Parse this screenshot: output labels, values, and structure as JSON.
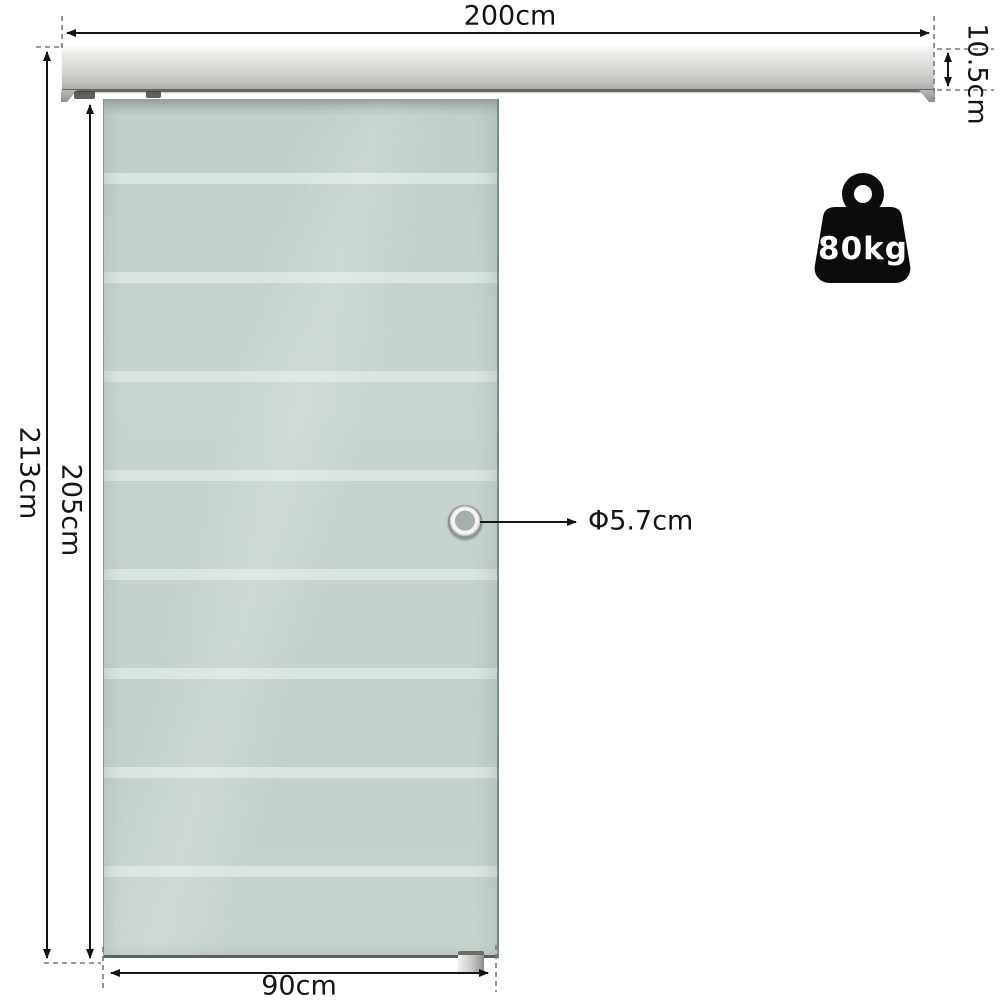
{
  "product": {
    "type_note": "sliding glass door with aluminium track",
    "weight_badge": {
      "label": "80kg",
      "icon": "kettlebell-weight-icon",
      "color": "#0c0c0c",
      "text_color": "#ffffff"
    }
  },
  "dimensions": {
    "track_width": "200cm",
    "track_height": "10.5cm",
    "overall_height": "213cm",
    "door_height": "205cm",
    "door_width": "90cm",
    "handle_diameter": "Φ5.7cm"
  },
  "colors": {
    "background": "#ffffff",
    "glass": "#c6d4ce",
    "glass_stripe": "#d9e4de",
    "track_light": "#f0f0ed",
    "track_dark": "#abaaa6",
    "dimension_line": "#151515",
    "dashed_guide": "#7a7a7a"
  }
}
